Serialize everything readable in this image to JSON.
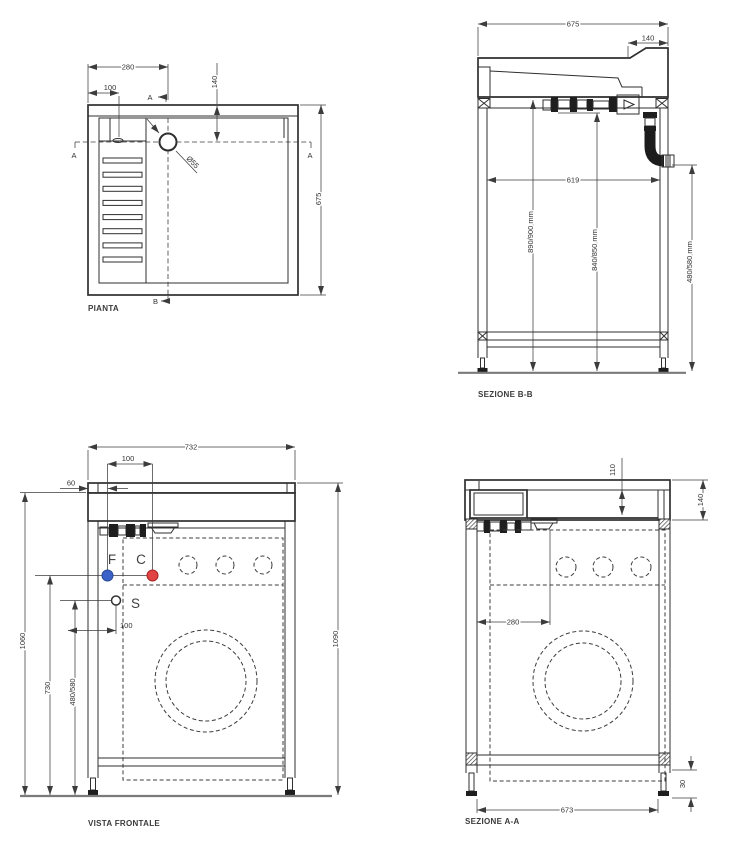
{
  "drawing": {
    "pianta": {
      "title": "PIANTA",
      "dim_width": "280",
      "dim_tap_offset": "100",
      "dim_depth_back": "140",
      "dim_depth": "675",
      "drain_diameter": "Ø55",
      "marker_a": "A",
      "marker_b": "B"
    },
    "sezione_bb": {
      "title": "SEZIONE B-B",
      "dim_width": "675",
      "dim_back_ledge": "140",
      "dim_inner_width": "619",
      "dim_height_worktop": "890/900 mm",
      "dim_height_drain_attach": "840/850 mm",
      "dim_height_outlet": "480/580 mm"
    },
    "vista_frontale": {
      "title": "VISTA FRONTALE",
      "dim_width": "732",
      "dim_tap_spacing": "100",
      "dim_tap_edge": "60",
      "dim_height_worktop": "1060",
      "dim_height_taps": "730",
      "dim_height_drain": "480/580",
      "dim_drain_offset": "100",
      "dim_height_total": "1090",
      "label_cold": "F",
      "label_hot": "C",
      "label_drain": "S"
    },
    "sezione_aa": {
      "title": "SEZIONE A-A",
      "dim_basin_depth": "110",
      "dim_top_height": "140",
      "dim_drain_offset": "280",
      "dim_width": "673",
      "dim_foot_adjust": "30"
    },
    "colors": {
      "cold_water": "#3a62c8",
      "hot_water": "#e04444",
      "line": "#2f2f2f"
    }
  }
}
